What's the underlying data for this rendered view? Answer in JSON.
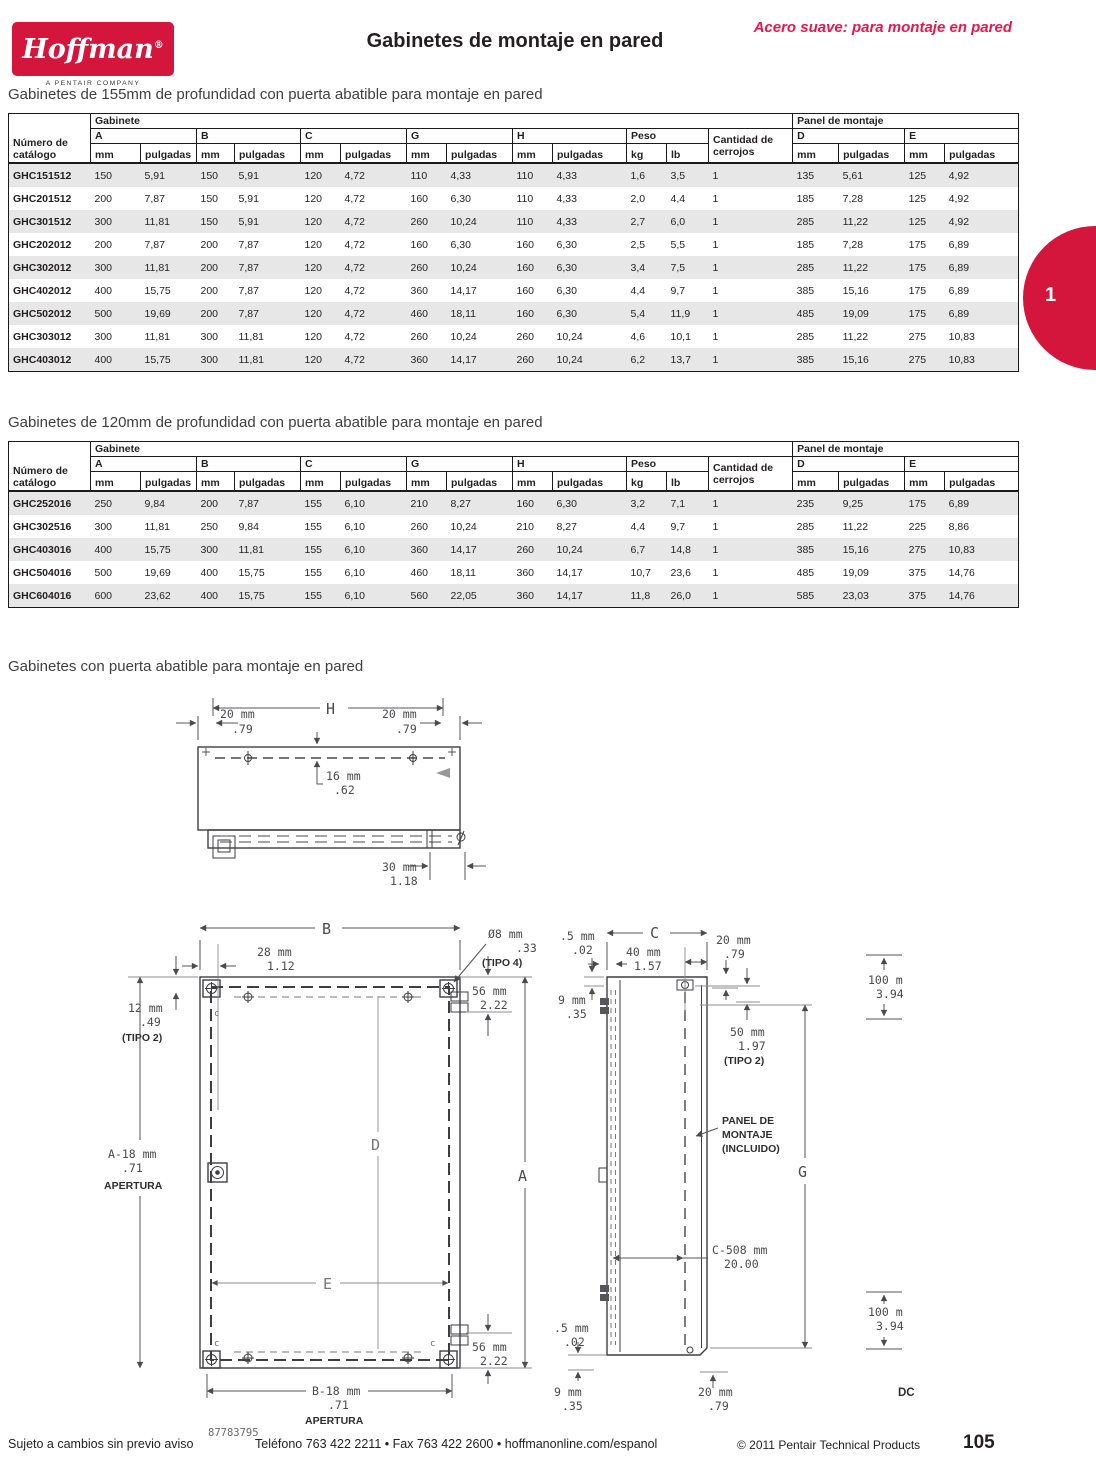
{
  "header": {
    "brand": "Hoffman",
    "reg": "®",
    "brand_sub": "A PENTAIR COMPANY",
    "title": "Gabinetes de montaje en pared",
    "tagline": "Acero suave: para montaje en pared",
    "tab_number": "1"
  },
  "colors": {
    "brand_red": "#d4163c",
    "tagline_red": "#e8174b",
    "row_shade": "#e7e7e8"
  },
  "tables": {
    "headers": {
      "catalogo": "Número de catálogo",
      "gabinete": "Gabinete",
      "panel": "Panel de montaje",
      "a": "A",
      "b": "B",
      "c": "C",
      "g": "G",
      "h": "H",
      "peso": "Peso",
      "cerrojos": "Cantidad de cerrojos",
      "d": "D",
      "e": "E",
      "mm": "mm",
      "pulgadas": "pulgadas",
      "kg": "kg",
      "lb": "lb"
    },
    "t155": {
      "heading": "Gabinetes de 155mm de profundidad con puerta abatible para montaje en pared",
      "rows": [
        [
          "GHC151512",
          "150",
          "5,91",
          "150",
          "5,91",
          "120",
          "4,72",
          "110",
          "4,33",
          "110",
          "4,33",
          "1,6",
          "3,5",
          "1",
          "135",
          "5,61",
          "125",
          "4,92"
        ],
        [
          "GHC201512",
          "200",
          "7,87",
          "150",
          "5,91",
          "120",
          "4,72",
          "160",
          "6,30",
          "110",
          "4,33",
          "2,0",
          "4,4",
          "1",
          "185",
          "7,28",
          "125",
          "4,92"
        ],
        [
          "GHC301512",
          "300",
          "11,81",
          "150",
          "5,91",
          "120",
          "4,72",
          "260",
          "10,24",
          "110",
          "4,33",
          "2,7",
          "6,0",
          "1",
          "285",
          "11,22",
          "125",
          "4,92"
        ],
        [
          "GHC202012",
          "200",
          "7,87",
          "200",
          "7,87",
          "120",
          "4,72",
          "160",
          "6,30",
          "160",
          "6,30",
          "2,5",
          "5,5",
          "1",
          "185",
          "7,28",
          "175",
          "6,89"
        ],
        [
          "GHC302012",
          "300",
          "11,81",
          "200",
          "7,87",
          "120",
          "4,72",
          "260",
          "10,24",
          "160",
          "6,30",
          "3,4",
          "7,5",
          "1",
          "285",
          "11,22",
          "175",
          "6,89"
        ],
        [
          "GHC402012",
          "400",
          "15,75",
          "200",
          "7,87",
          "120",
          "4,72",
          "360",
          "14,17",
          "160",
          "6,30",
          "4,4",
          "9,7",
          "1",
          "385",
          "15,16",
          "175",
          "6,89"
        ],
        [
          "GHC502012",
          "500",
          "19,69",
          "200",
          "7,87",
          "120",
          "4,72",
          "460",
          "18,11",
          "160",
          "6,30",
          "5,4",
          "11,9",
          "1",
          "485",
          "19,09",
          "175",
          "6,89"
        ],
        [
          "GHC303012",
          "300",
          "11,81",
          "300",
          "11,81",
          "120",
          "4,72",
          "260",
          "10,24",
          "260",
          "10,24",
          "4,6",
          "10,1",
          "1",
          "285",
          "11,22",
          "275",
          "10,83"
        ],
        [
          "GHC403012",
          "400",
          "15,75",
          "300",
          "11,81",
          "120",
          "4,72",
          "360",
          "14,17",
          "260",
          "10,24",
          "6,2",
          "13,7",
          "1",
          "385",
          "15,16",
          "275",
          "10,83"
        ]
      ]
    },
    "t120": {
      "heading": "Gabinetes de 120mm de profundidad con puerta abatible para montaje en pared",
      "rows": [
        [
          "GHC252016",
          "250",
          "9,84",
          "200",
          "7,87",
          "155",
          "6,10",
          "210",
          "8,27",
          "160",
          "6,30",
          "3,2",
          "7,1",
          "1",
          "235",
          "9,25",
          "175",
          "6,89"
        ],
        [
          "GHC302516",
          "300",
          "11,81",
          "250",
          "9,84",
          "155",
          "6,10",
          "260",
          "10,24",
          "210",
          "8,27",
          "4,4",
          "9,7",
          "1",
          "285",
          "11,22",
          "225",
          "8,86"
        ],
        [
          "GHC403016",
          "400",
          "15,75",
          "300",
          "11,81",
          "155",
          "6,10",
          "360",
          "14,17",
          "260",
          "10,24",
          "6,7",
          "14,8",
          "1",
          "385",
          "15,16",
          "275",
          "10,83"
        ],
        [
          "GHC504016",
          "500",
          "19,69",
          "400",
          "15,75",
          "155",
          "6,10",
          "460",
          "18,11",
          "360",
          "14,17",
          "10,7",
          "23,6",
          "1",
          "485",
          "19,09",
          "375",
          "14,76"
        ],
        [
          "GHC604016",
          "600",
          "23,62",
          "400",
          "15,75",
          "155",
          "6,10",
          "560",
          "22,05",
          "360",
          "14,17",
          "11,8",
          "26,0",
          "1",
          "585",
          "23,03",
          "375",
          "14,76"
        ]
      ]
    }
  },
  "drawings": {
    "heading": "Gabinetes con puerta abatible para montaje en pared",
    "top": {
      "h": "H",
      "d20a": "20 mm",
      "d20b": ".79",
      "d16a": "16 mm",
      "d16b": ".62",
      "d30a": "30 mm",
      "d30b": "1.18"
    },
    "front": {
      "b": "B",
      "d28a": "28 mm",
      "d28b": "1.12",
      "dia": "Ø8 mm",
      "dia2": ".33",
      "tipo4": "(TIPO 4)",
      "d56a": "56 mm",
      "d56b": "2.22",
      "d12a": "12 mm",
      "d12b": ".49",
      "tipo2": "(TIPO 2)",
      "a18": "A-18 mm",
      "i71": ".71",
      "ap": "APERTURA",
      "d": "D",
      "a": "A",
      "e": "E",
      "b18": "B-18 mm",
      "num": "87783795",
      "c": "c"
    },
    "side": {
      "d05": ".5 mm",
      "i02": ".02",
      "c": "C",
      "d40a": "40 mm",
      "d40b": "1.57",
      "d20a": "20 mm",
      "d20b": ".79",
      "d9a": "9 mm",
      "d9b": ".35",
      "d50a": "50 mm",
      "d50b": "1.97",
      "tipo2": "(TIPO 2)",
      "p1": "PANEL DE",
      "p2": "MONTAJE",
      "p3": "(INCLUIDO)",
      "g": "G",
      "c508a": "C-508 mm",
      "c508b": "20.00",
      "d100a": "100 m",
      "d100b": "3.94",
      "dc": "DC"
    }
  },
  "footer": {
    "left": "Sujeto a cambios sin previo aviso",
    "center": "Teléfono 763 422 2211 • Fax 763 422 2600 • hoffmanonline.com/espanol",
    "right": "© 2011 Pentair Technical Products",
    "page_number": "105"
  }
}
